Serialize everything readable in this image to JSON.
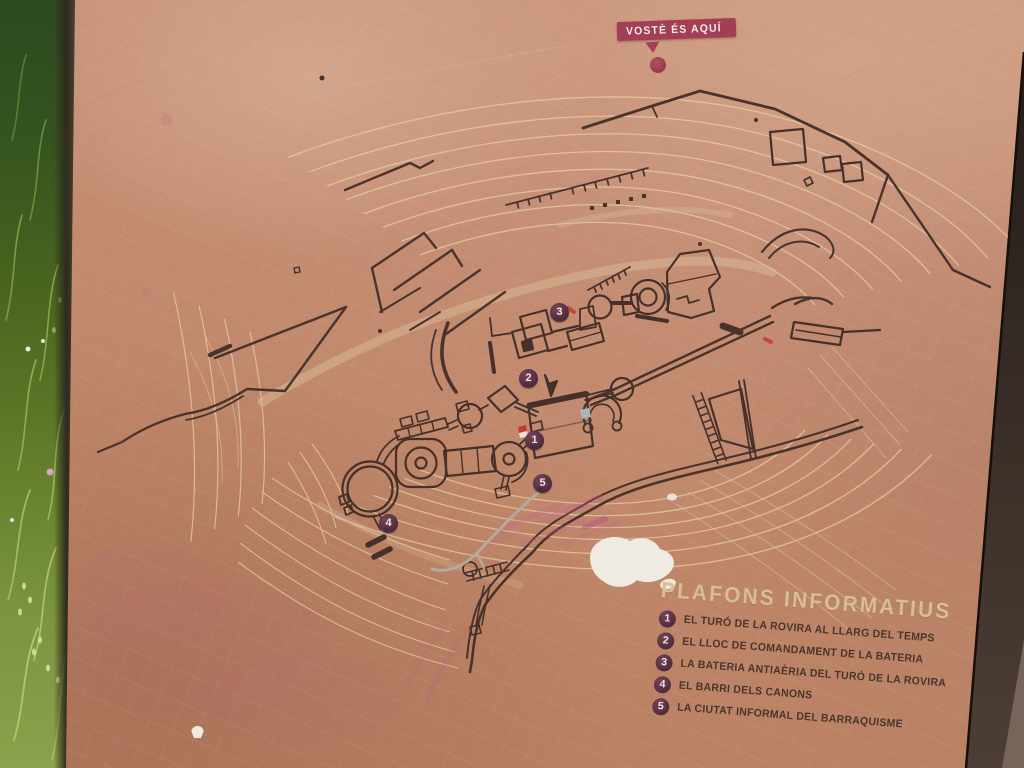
{
  "you_are_here": {
    "label": "VOSTÈ ÉS AQUÍ"
  },
  "legend": {
    "title": "PLAFONS INFORMATIUS",
    "items": [
      {
        "num": "1",
        "label": "EL TURÓ DE LA ROVIRA AL LLARG DEL TEMPS"
      },
      {
        "num": "2",
        "label": "EL LLOC DE COMANDAMENT DE LA BATERIA"
      },
      {
        "num": "3",
        "label": "LA BATERIA ANTIAÈRIA DEL TURÓ DE LA ROVIRA"
      },
      {
        "num": "4",
        "label": "EL BARRI DELS CANONS"
      },
      {
        "num": "5",
        "label": "LA CIUTAT INFORMAL DEL BARRAQUISME"
      }
    ]
  },
  "map_markers": [
    {
      "num": "1"
    },
    {
      "num": "2"
    },
    {
      "num": "3"
    },
    {
      "num": "4"
    },
    {
      "num": "5"
    }
  ],
  "colors": {
    "panel_base": "#c08a6e",
    "panel_light": "#cd9a7e",
    "panel_dark": "#b47a5e",
    "map_line": "#4a332c",
    "contour_cream": "#e7d1a9",
    "accent_red": "#a33f54",
    "marker_plum": "#4e2b3d",
    "legend_title_cream": "#d6bf93",
    "legend_text_brown": "#4a352c",
    "grass_dark_green": "#2c4a20",
    "grass_light_green": "#8ba24c"
  }
}
